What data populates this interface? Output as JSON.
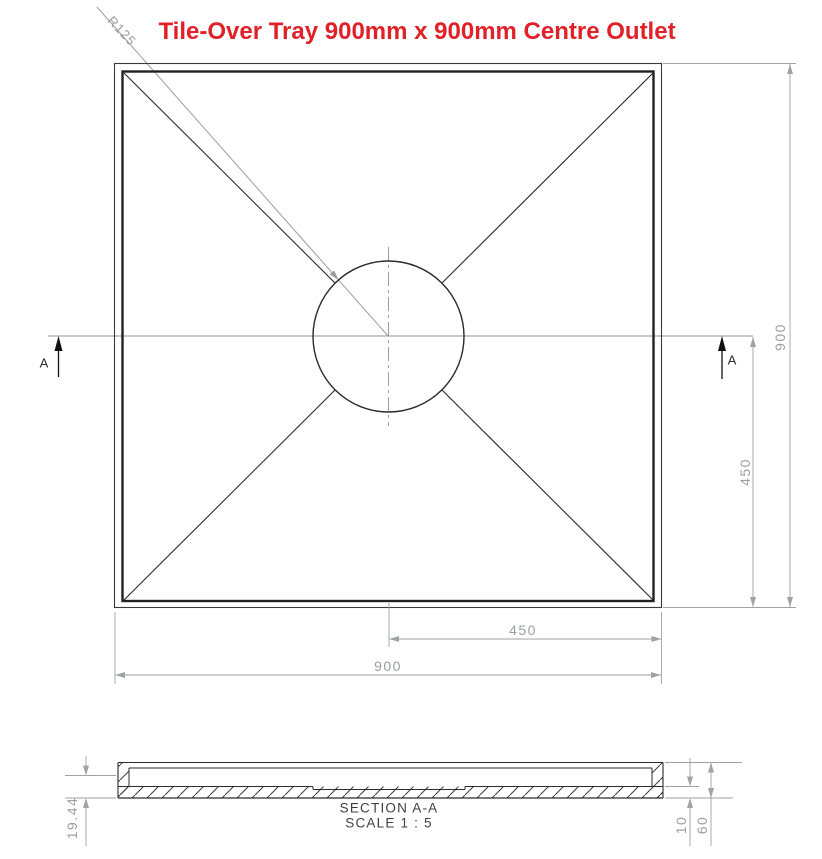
{
  "title": "Tile-Over Tray 900mm x 900mm Centre Outlet",
  "colors": {
    "title_red": "#e02128",
    "drawing_line": "#2b2b2b",
    "dimension_gray": "#9b9da0"
  },
  "plan_view": {
    "radius_label": "R125",
    "section_cut_letter": "A",
    "dimensions": {
      "overall_width": "900",
      "half_width": "450",
      "overall_height": "900",
      "half_height": "450"
    }
  },
  "section_view": {
    "name": "SECTION A-A",
    "scale": "SCALE 1 : 5",
    "dimensions": {
      "edge_height": "19.44",
      "base_thickness": "10",
      "overall_height": "60"
    }
  }
}
